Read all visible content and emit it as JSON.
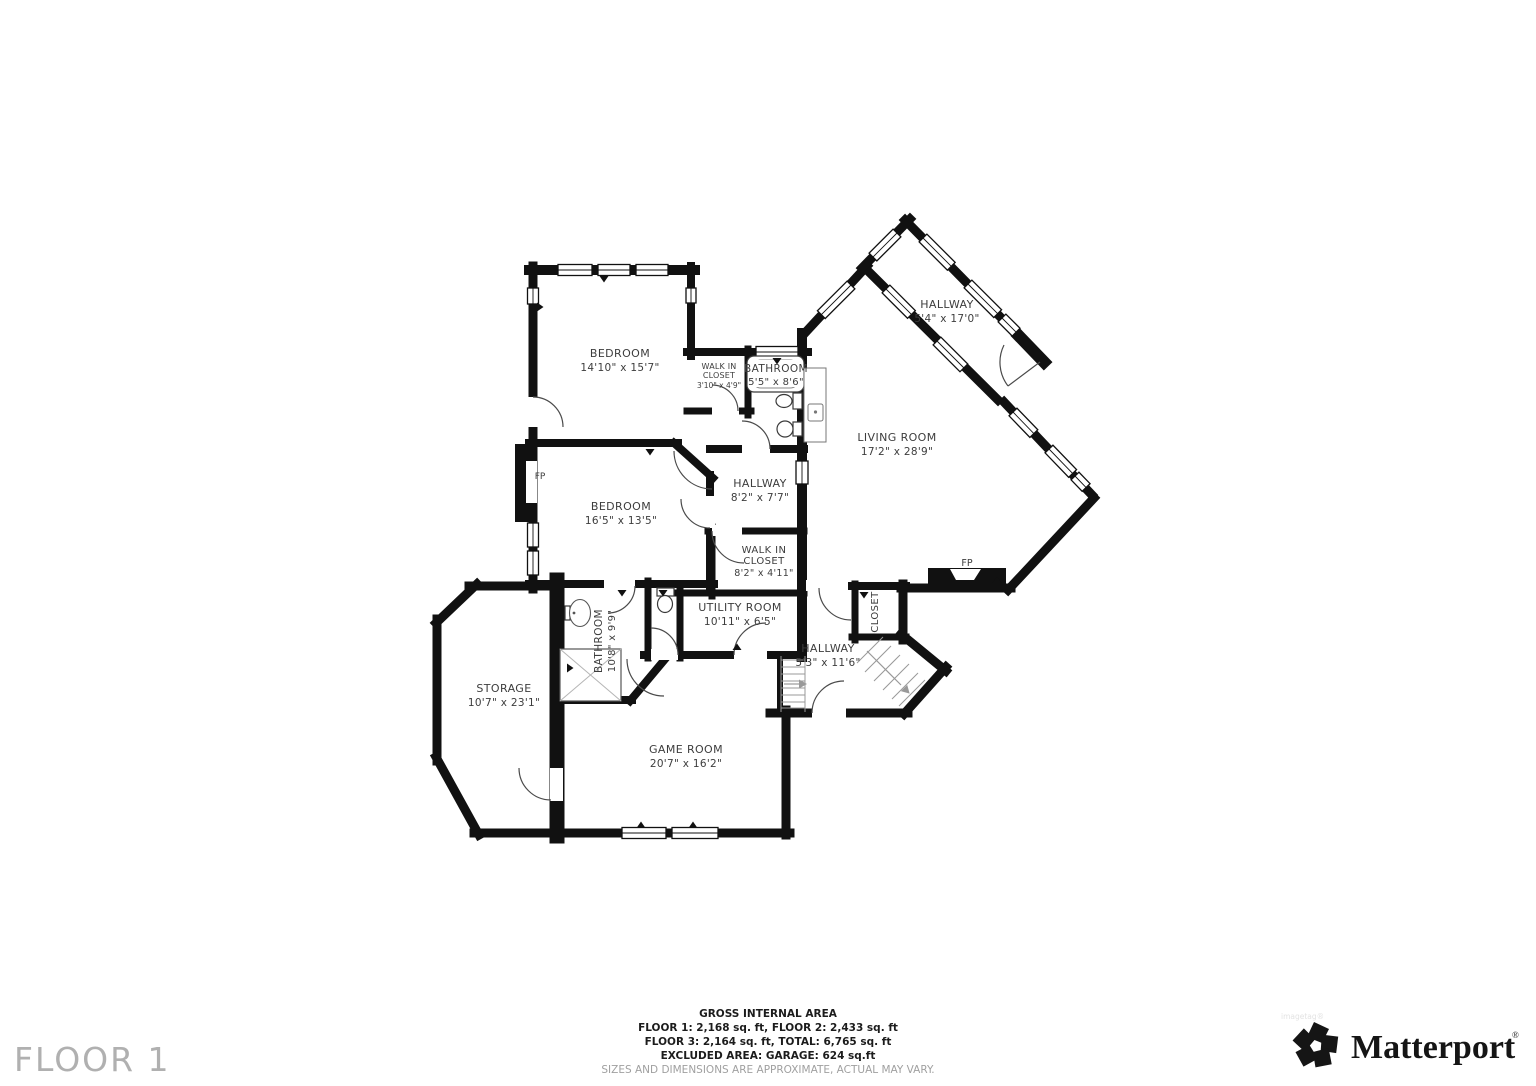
{
  "floor": {
    "label": "FLOOR 1"
  },
  "rooms": {
    "bedroom1": {
      "name": "BEDROOM",
      "dims": "14'10\" x 15'7\""
    },
    "wic_upper": {
      "line1": "WALK IN",
      "line2": "CLOSET",
      "dims": "3'10\" x 4'9\""
    },
    "bath_upper": {
      "name": "BATHROOM",
      "dims": "5'5\" x 8'6\""
    },
    "hall_upper": {
      "name": "HALLWAY",
      "dims": "5'4\" x 17'0\""
    },
    "living": {
      "name": "LIVING ROOM",
      "dims": "17'2\" x 28'9\""
    },
    "bedroom2": {
      "name": "BEDROOM",
      "dims": "16'5\" x 13'5\""
    },
    "hall_mid": {
      "name": "HALLWAY",
      "dims": "8'2\" x 7'7\""
    },
    "wic_lower": {
      "line1": "WALK IN",
      "line2": "CLOSET",
      "dims": "8'2\" x 4'11\""
    },
    "utility": {
      "name": "UTILITY ROOM",
      "dims": "10'11\" x 6'5\""
    },
    "bath_lower": {
      "name": "BATHROOM",
      "dims": "10'8\" x 9'9\""
    },
    "closet": {
      "name": "CLOSET"
    },
    "hall_lower": {
      "name": "HALLWAY",
      "dims": "5'3\" x 11'6\""
    },
    "storage": {
      "name": "STORAGE",
      "dims": "10'7\" x 23'1\""
    },
    "game": {
      "name": "GAME ROOM",
      "dims": "20'7\" x 16'2\""
    },
    "fireplace": {
      "label": "FP"
    }
  },
  "footer": {
    "title": "GROSS INTERNAL AREA",
    "line1": "FLOOR 1: 2,168 sq. ft, FLOOR 2: 2,433 sq. ft",
    "line2": "FLOOR 3: 2,164 sq. ft, TOTAL: 6,765 sq. ft",
    "line3": "EXCLUDED AREA: GARAGE: 624 sq.ft",
    "disclaimer": "SIZES AND DIMENSIONS ARE APPROXIMATE, ACTUAL MAY VARY."
  },
  "brand": {
    "name": "Matterport",
    "registered": "®",
    "watermark": "imagetag®"
  },
  "colors": {
    "wall": "#111111",
    "label": "#3d3d3d",
    "muted": "#a0a0a0",
    "floor_label": "#b0b0b0"
  }
}
